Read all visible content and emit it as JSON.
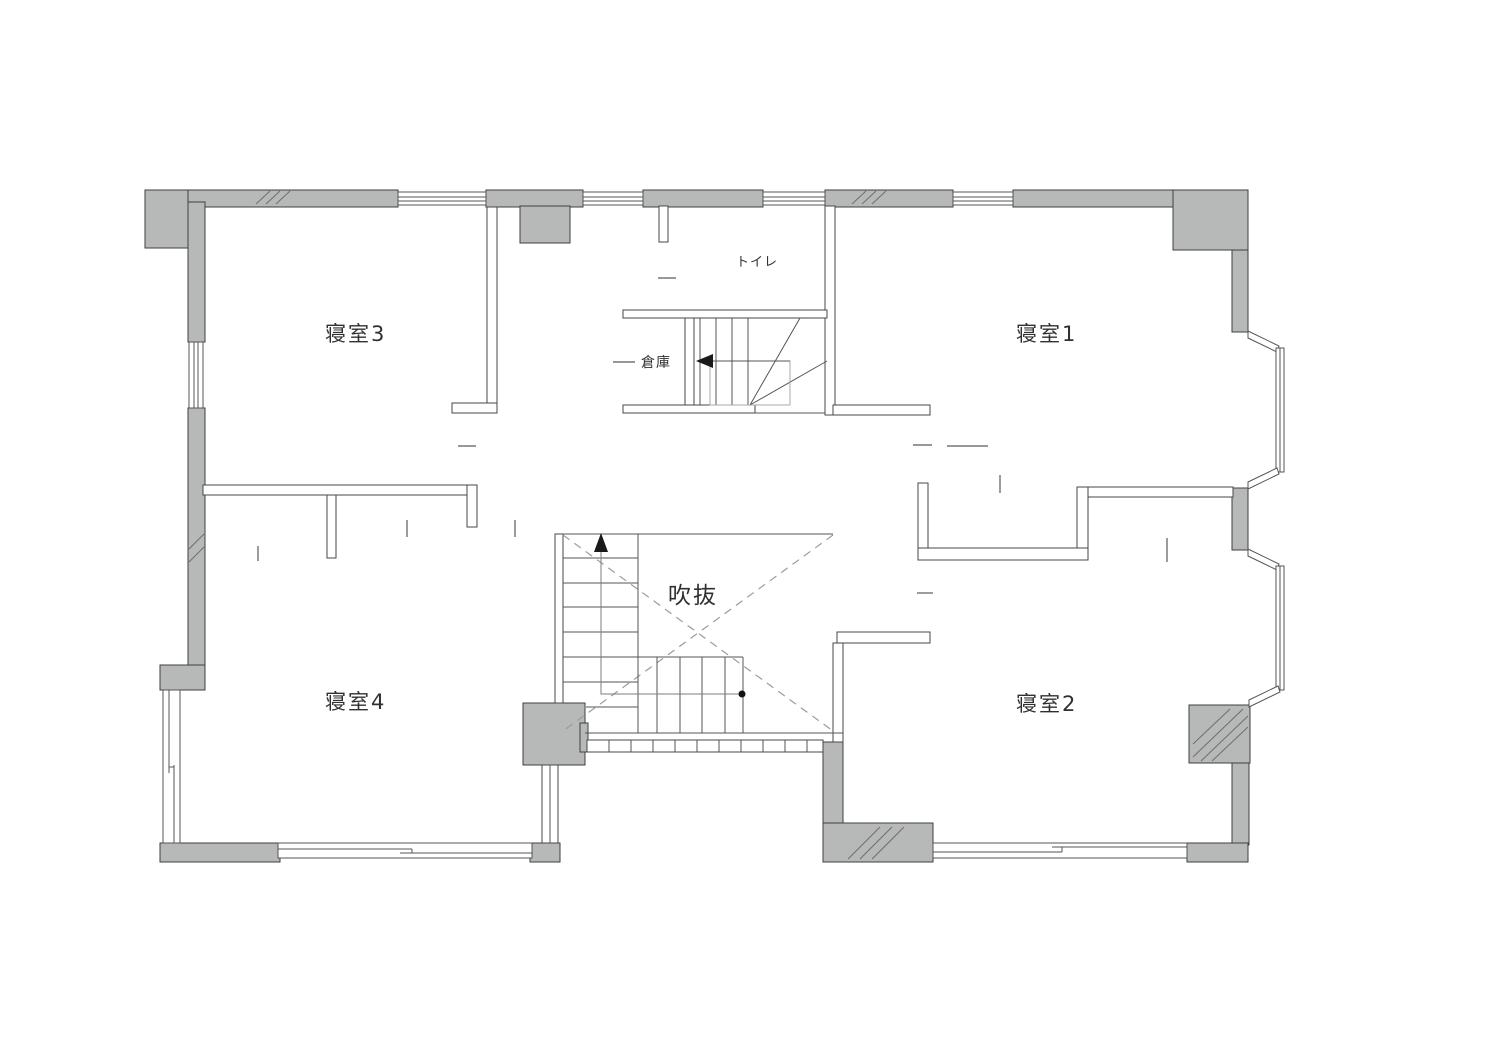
{
  "plan": {
    "title": "2F floor plan",
    "labels": {
      "bedroom1": "寝室1",
      "bedroom2": "寝室2",
      "bedroom3": "寝室3",
      "bedroom4": "寝室4",
      "toilet": "トイレ",
      "storage": "倉庫",
      "void": "吹抜"
    },
    "rooms": [
      {
        "id": "bedroom3",
        "label": "寝室3",
        "position": "top-left"
      },
      {
        "id": "bedroom1",
        "label": "寝室1",
        "position": "top-right"
      },
      {
        "id": "bedroom4",
        "label": "寝室4",
        "position": "bottom-left"
      },
      {
        "id": "bedroom2",
        "label": "寝室2",
        "position": "bottom-right"
      },
      {
        "id": "toilet",
        "label": "トイレ",
        "position": "top-center"
      },
      {
        "id": "storage",
        "label": "倉庫",
        "position": "center-left-of-stairs"
      },
      {
        "id": "void",
        "label": "吹抜",
        "position": "center"
      }
    ],
    "symbols": {
      "stair_up_arrow": "up-arrow",
      "stair_down_arrow": "left-arrow",
      "stair_start_dot": "dot",
      "void_cross": "dashed-x"
    },
    "colors": {
      "wall_fill": "#b7b8b8",
      "wall_stroke": "#3f3f3f",
      "line": "#555555",
      "dashed": "#9b9b9b",
      "background": "#ffffff",
      "text": "#303030"
    }
  }
}
